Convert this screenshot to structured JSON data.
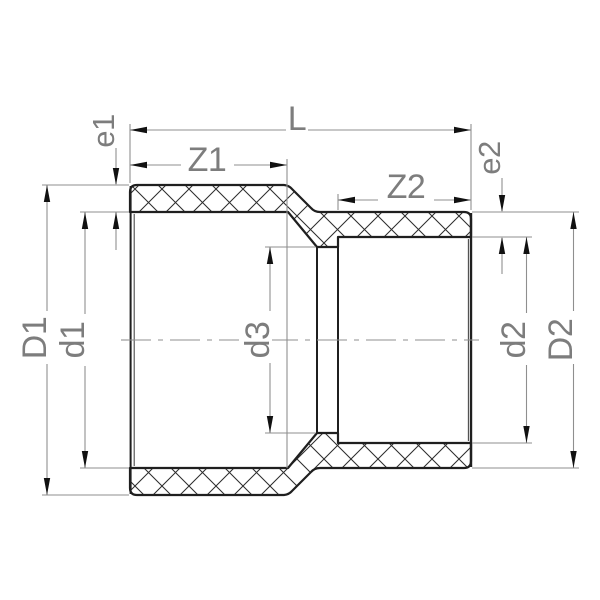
{
  "drawing": {
    "dimension_labels": {
      "overall_length": "L",
      "insertion_depth_left": "Z1",
      "insertion_depth_right": "Z2",
      "wall_thickness_left": "e1",
      "wall_thickness_right": "e2",
      "outer_diameter_left": "D1",
      "socket_bore_left": "d1",
      "through_bore": "d3",
      "socket_bore_right": "d2",
      "outer_diameter_right": "D2"
    },
    "colors": {
      "background": "#ffffff",
      "outline": "#1f1f1f",
      "hatch": "#2d2d2d",
      "dimension_line": "#8f8f8f",
      "label_text": "#7d7d7d",
      "arrow": "#111111"
    }
  }
}
